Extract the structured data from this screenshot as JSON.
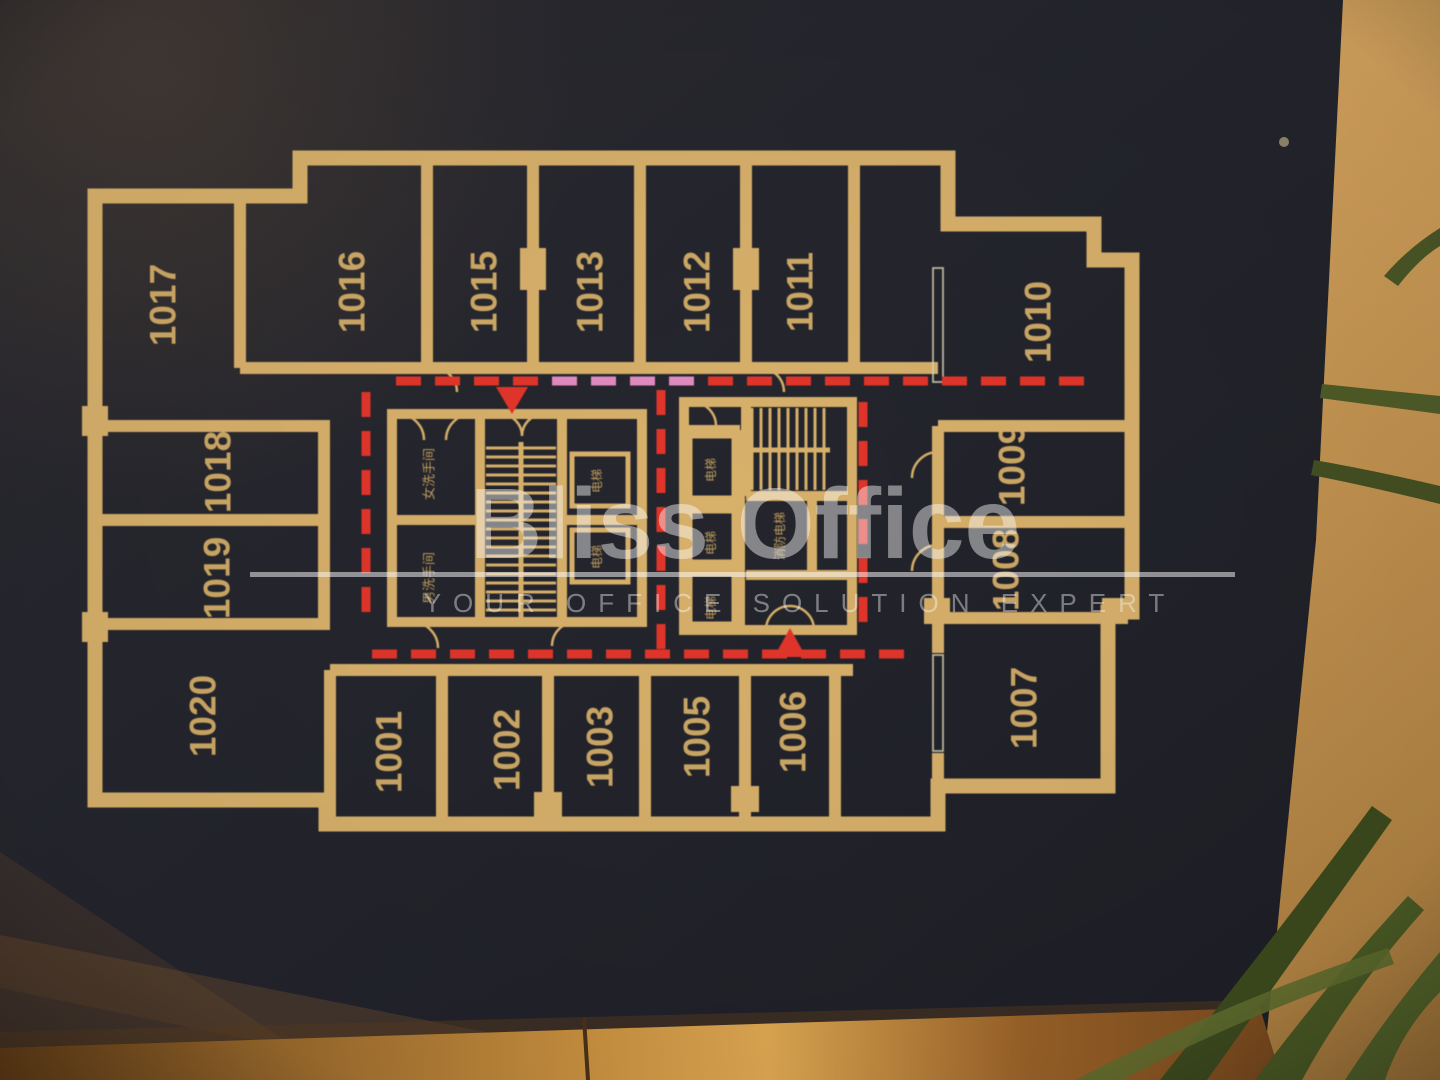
{
  "watermark": {
    "brand": "Bliss Office",
    "tagline": "YOUR OFFICE SOLUTION EXPERT"
  },
  "sign": {
    "background_color": "#24252d",
    "wall_line_color": "#d7b06a",
    "route_red": "#e2352a",
    "route_pink": "#e18bc0"
  },
  "floor_plan": {
    "rooms": [
      {
        "label": "1017",
        "x": 163,
        "y": 305
      },
      {
        "label": "1016",
        "x": 352,
        "y": 292
      },
      {
        "label": "1015",
        "x": 484,
        "y": 292
      },
      {
        "label": "1013",
        "x": 590,
        "y": 292
      },
      {
        "label": "1012",
        "x": 697,
        "y": 292
      },
      {
        "label": "1011",
        "x": 800,
        "y": 292
      },
      {
        "label": "1010",
        "x": 1038,
        "y": 322
      },
      {
        "label": "1018",
        "x": 218,
        "y": 472
      },
      {
        "label": "1019",
        "x": 217,
        "y": 578
      },
      {
        "label": "1009",
        "x": 1012,
        "y": 465
      },
      {
        "label": "1008",
        "x": 1006,
        "y": 570
      },
      {
        "label": "1020",
        "x": 203,
        "y": 716
      },
      {
        "label": "1001",
        "x": 389,
        "y": 752
      },
      {
        "label": "1002",
        "x": 507,
        "y": 750
      },
      {
        "label": "1003",
        "x": 600,
        "y": 747
      },
      {
        "label": "1005",
        "x": 697,
        "y": 737
      },
      {
        "label": "1006",
        "x": 793,
        "y": 732
      },
      {
        "label": "1007",
        "x": 1024,
        "y": 708
      }
    ],
    "facilities": [
      {
        "label": "女洗手间",
        "x": 429,
        "y": 474,
        "size": 13
      },
      {
        "label": "男洗手间",
        "x": 429,
        "y": 578,
        "size": 13
      },
      {
        "label": "电梯",
        "x": 597,
        "y": 481,
        "size": 12
      },
      {
        "label": "电梯",
        "x": 597,
        "y": 557,
        "size": 12
      },
      {
        "label": "电梯",
        "x": 711,
        "y": 470,
        "size": 12
      },
      {
        "label": "电梯",
        "x": 711,
        "y": 543,
        "size": 12
      },
      {
        "label": "电梯",
        "x": 711,
        "y": 608,
        "size": 12
      },
      {
        "label": "消防电梯",
        "x": 780,
        "y": 536,
        "size": 12
      }
    ],
    "route_lines": [
      {
        "dir": "h",
        "y": 381,
        "from": 396,
        "to": 1092,
        "pink_from": 540,
        "pink_to": 672
      },
      {
        "dir": "h",
        "y": 654,
        "from": 372,
        "to": 933
      },
      {
        "dir": "v",
        "x": 366,
        "from": 392,
        "to": 648
      },
      {
        "dir": "v",
        "x": 661,
        "from": 390,
        "to": 650
      },
      {
        "dir": "v",
        "x": 863,
        "from": 402,
        "to": 658
      }
    ],
    "exit_arrows": [
      {
        "points": "496,387 528,387 512,414"
      },
      {
        "points": "774,657 806,657 790,628"
      }
    ]
  }
}
